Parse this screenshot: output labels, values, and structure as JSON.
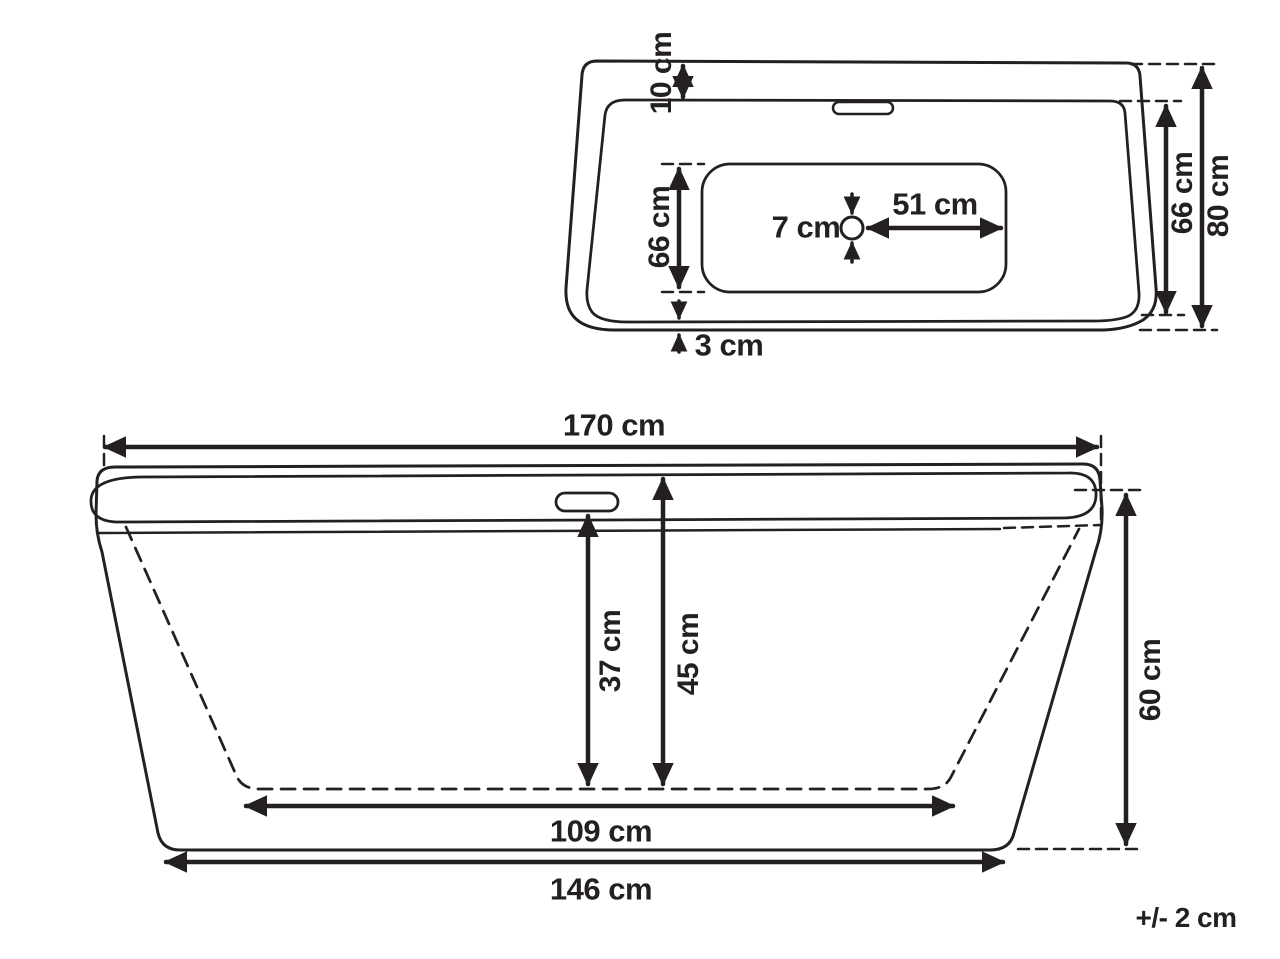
{
  "title": "Bathtub dimensions technical drawing",
  "colors": {
    "ink": "#241f21",
    "background": "#ffffff"
  },
  "tolerance_note": "+/- 2 cm",
  "top_view": {
    "view_name": "top view",
    "rim_top_offset": "10 cm",
    "basin_floor_width": "66 cm",
    "drain_diameter": "7 cm",
    "drain_to_floor_edge": "51 cm",
    "inner_rim_width": "66 cm",
    "overall_width": "80 cm",
    "rim_bottom_offset": "3 cm"
  },
  "side_view": {
    "view_name": "side view",
    "overall_length": "170 cm",
    "overflow_to_floor_depth": "37 cm",
    "rim_to_floor_depth": "45 cm",
    "overall_height": "60 cm",
    "basin_floor_length": "109 cm",
    "base_length": "146 cm"
  }
}
